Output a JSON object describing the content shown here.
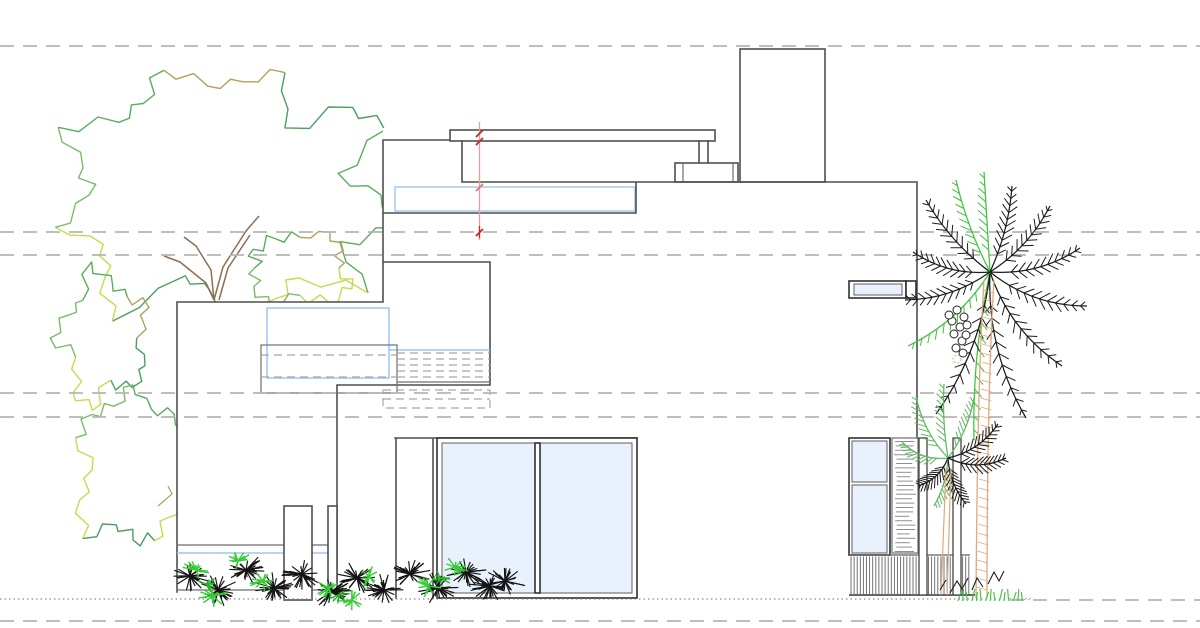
{
  "drawing": {
    "type": "architectural-side-elevation",
    "canvas": {
      "width": 1200,
      "height": 628,
      "background": "#ffffff"
    },
    "datum_lines_y": [
      46,
      232,
      255,
      393,
      417,
      621
    ],
    "ground": {
      "y": 599,
      "dotted_end_x": 1010
    },
    "dimension_line": {
      "x": 479.5,
      "y_top": 122,
      "y_bottom": 240,
      "tick_ys": [
        133.5,
        141.5,
        187.5,
        232.5
      ]
    },
    "palette": {
      "background": "#ffffff",
      "line_dark": "#4f4f4f",
      "line_medium": "#6e6e6e",
      "frame_dark": "#303030",
      "glass_fill": "#e9f2fc",
      "glass_stroke": "#5f5f5f",
      "blue_line": "#9cc7f2",
      "band_blue": "#a5c9ef",
      "datum_gray": "#b5b5b5",
      "hidden_dash": "#a6a6a6",
      "ground_gray": "#8c8c8c",
      "dim_red": "#c62828",
      "dim_red_mid": "#e57373",
      "dim_red_light": "#ef9a9a",
      "tree_green1": "#5aad5a",
      "tree_green2": "#4b9e63",
      "tree_green3": "#79bd66",
      "tree_yellow": "#c9d94d",
      "tree_tan": "#b2a05e",
      "branch_brown": "#8d6e52",
      "palm_black": "#1c1c1c",
      "palm_green": "#3cc43c",
      "palm_green2": "#63b863",
      "trunk_tan": "#e0a87c",
      "shrub_black": "#141414",
      "shrub_green": "#36cd36",
      "shrub_green_dark": "#24b324",
      "fence_gray": "#5f5f5f",
      "slat_gray": "#8f8f8f"
    }
  }
}
